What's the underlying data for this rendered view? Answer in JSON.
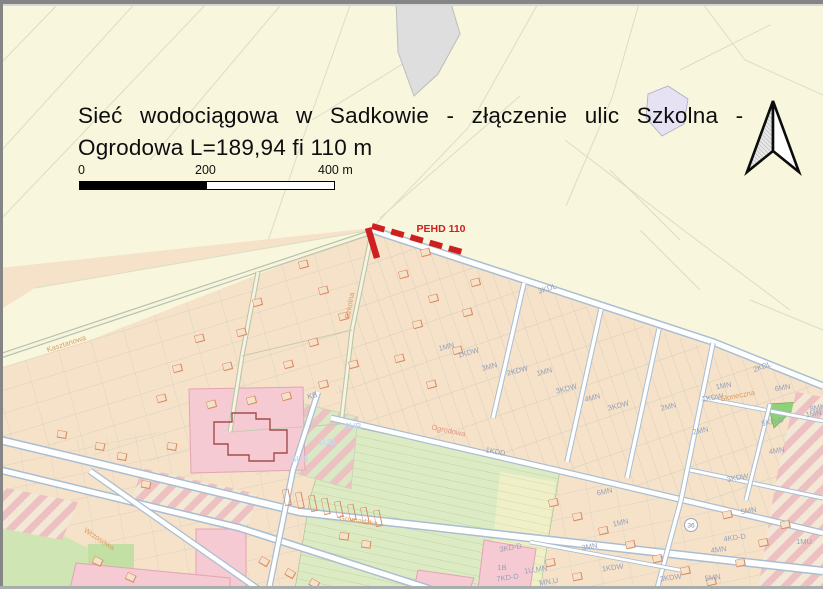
{
  "title": {
    "line1": "Sieć wodociągowa w Sadkowie - złączenie ulic Szkolna -",
    "line2": "Ogrodowa L=189,94 fi 110 m"
  },
  "scale_bar": {
    "tick_0": "0",
    "tick_200": "200",
    "tick_400": "400 m"
  },
  "pipeline": {
    "label": "PEHD 110",
    "color": "#ce2020"
  },
  "map": {
    "colors": {
      "fields_background": "#f8f6dd",
      "built_up_background": "#f6e2c9",
      "pink_zone": "#f5cad3",
      "green_zone": "#cfe5b4",
      "road_fill": "#ffffff",
      "road_casing": "#a9bed2",
      "pipeline_red": "#ce2020",
      "zone_label_text": "#95a1ba",
      "street_label_text": "#dd9b60"
    },
    "zone_labels": [
      "3KDL",
      "1MN",
      "1KDW",
      "3MN",
      "2KDW",
      "1MN",
      "3KDW",
      "4MN",
      "3KDW",
      "2MN",
      "1KDW",
      "1MN",
      "6MN",
      "2KDL",
      "5KD-D",
      "1MN",
      "4MN",
      "3KDW",
      "5MN",
      "KB",
      "1KDD",
      "6MN",
      "1MN",
      "3MN",
      "3KD-D",
      "1B",
      "7KD-D",
      "1U,MN",
      "MN,U",
      "1KDW",
      "3KDW",
      "5MN",
      "4MN",
      "4KD-D",
      "1MU",
      "8MN",
      "2MN"
    ],
    "area_labels": [
      "6UB",
      "1UB",
      "5UB"
    ],
    "street_labels": [
      "Szkolna",
      "Ogrodowa",
      "Kasztanowa",
      "Wrzosowa",
      "Gromadzka",
      "Słoneczna"
    ],
    "road_badge": "36"
  }
}
